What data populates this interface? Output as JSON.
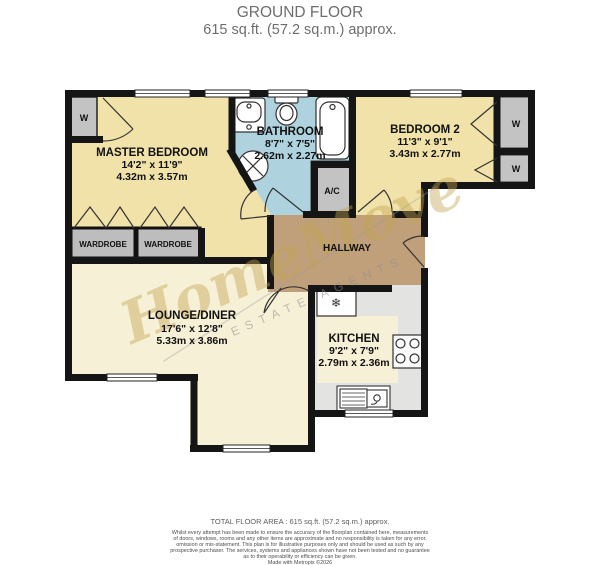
{
  "header": {
    "title": "GROUND FLOOR",
    "subtitle": "615 sq.ft. (57.2 sq.m.) approx."
  },
  "rooms": {
    "master_bedroom": {
      "name": "MASTER BEDROOM",
      "imperial": "14'2\"  x 11'9\"",
      "metric": "4.32m  x 3.57m"
    },
    "bathroom": {
      "name": "BATHROOM",
      "imperial": "8'7\"  x 7'5\"",
      "metric": "2.62m  x 2.27m"
    },
    "bedroom2": {
      "name": "BEDROOM 2",
      "imperial": "11'3\"  x 9'1\"",
      "metric": "3.43m  x 2.77m"
    },
    "lounge": {
      "name": "LOUNGE/DINER",
      "imperial": "17'6\"  x 12'8\"",
      "metric": "5.33m  x 3.86m"
    },
    "kitchen": {
      "name": "KITCHEN",
      "imperial": "9'2\"  x 7'9\"",
      "metric": "2.79m  x 2.36m"
    },
    "hallway": {
      "name": "HALLWAY"
    },
    "ac": {
      "name": "A/C"
    },
    "wardrobe_label": "WARDROBE",
    "closet_label": "W"
  },
  "icons": {
    "freezer": "❄"
  },
  "watermark": {
    "name": "HomeMove",
    "tagline": "ESTATE AGENTS"
  },
  "footer": {
    "total_area": "TOTAL FLOOR AREA : 615 sq.ft. (57.2 sq.m.) approx.",
    "disclaimer": [
      "Whilst every attempt has been made to ensure the accuracy of the floorplan contained here, measurements",
      "of doors, windows, rooms and any other items are approximate and no responsibility is taken for any error,",
      "omission or mis-statement. This plan is for illustrative purposes only and should be used as such by any",
      "prospective purchaser. The services, systems and appliances shown have not been tested and no guarantee",
      "as to their operability or efficiency can be given.",
      "Made with Metropix ©2026"
    ]
  },
  "colors": {
    "bedroom": "#f1e2a9",
    "bathroom": "#aed3de",
    "hallway": "#bfa07b",
    "lounge": "#f6f0d6",
    "kitchen_floor": "#e3e3e1",
    "closet": "#c3c3c3",
    "wall": "#151515",
    "header_text": "#6e6e6e",
    "watermark_gold": "#c3a44f"
  }
}
